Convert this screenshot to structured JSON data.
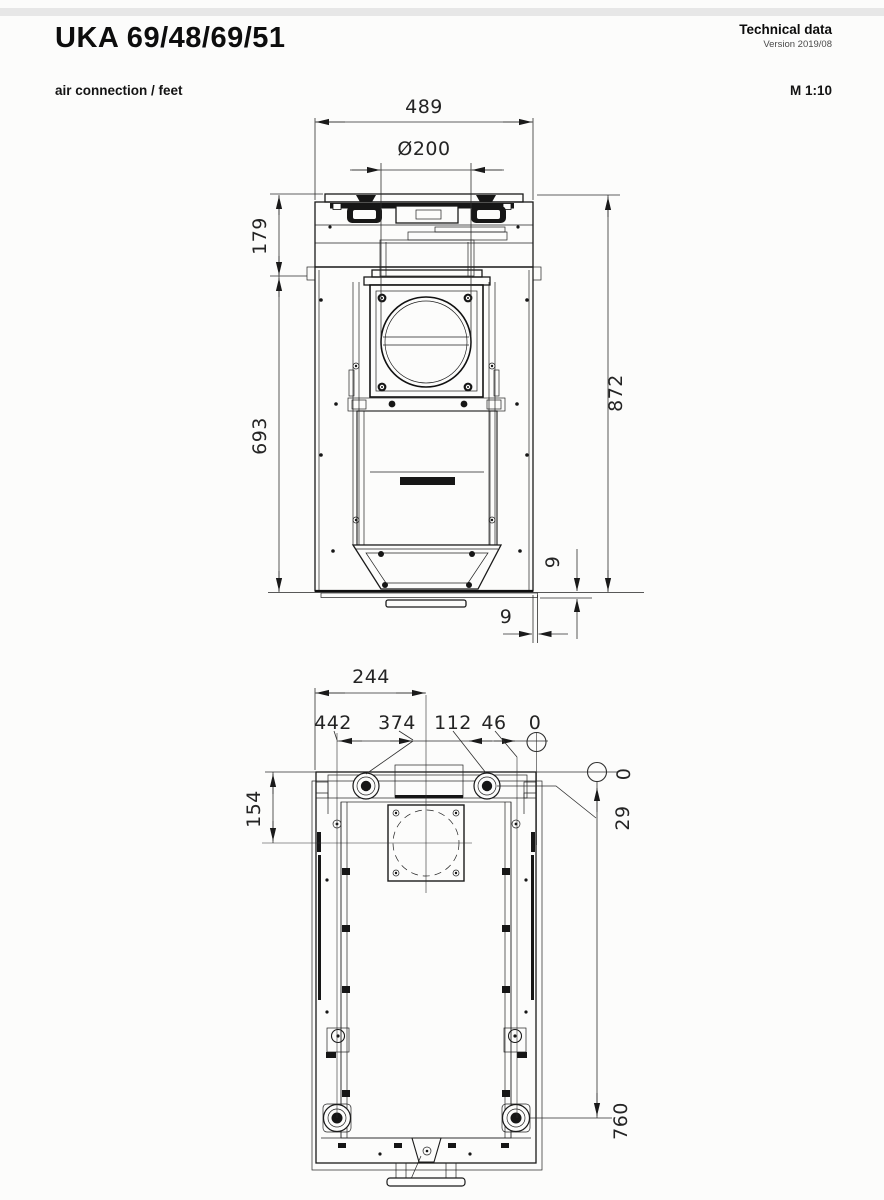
{
  "header": {
    "title": "UKA 69/48/69/51",
    "doc_type": "Technical data",
    "version": "Version 2019/08",
    "view_label": "air connection / feet",
    "scale_label": "M 1:10"
  },
  "colors": {
    "ink": "#1a1a1a",
    "paper": "#fcfcfb"
  },
  "front_view": {
    "dims": {
      "total_width": "489",
      "duct_diameter": "Ø200",
      "upper_height": "179",
      "lower_height": "693",
      "total_height": "872",
      "base_gap_vertical": "9",
      "base_gap_horizontal": "9"
    }
  },
  "plan_view": {
    "dims": {
      "center_from_left": "244",
      "rear_foot_x": "442",
      "front_left_foot_x": "374",
      "front_right_foot_x": "112",
      "rear_right_foot_x": "46",
      "datum_top": "0",
      "datum_right": "0",
      "front_feet_y": "29",
      "duct_center_y": "154",
      "rear_feet_y": "760"
    }
  }
}
